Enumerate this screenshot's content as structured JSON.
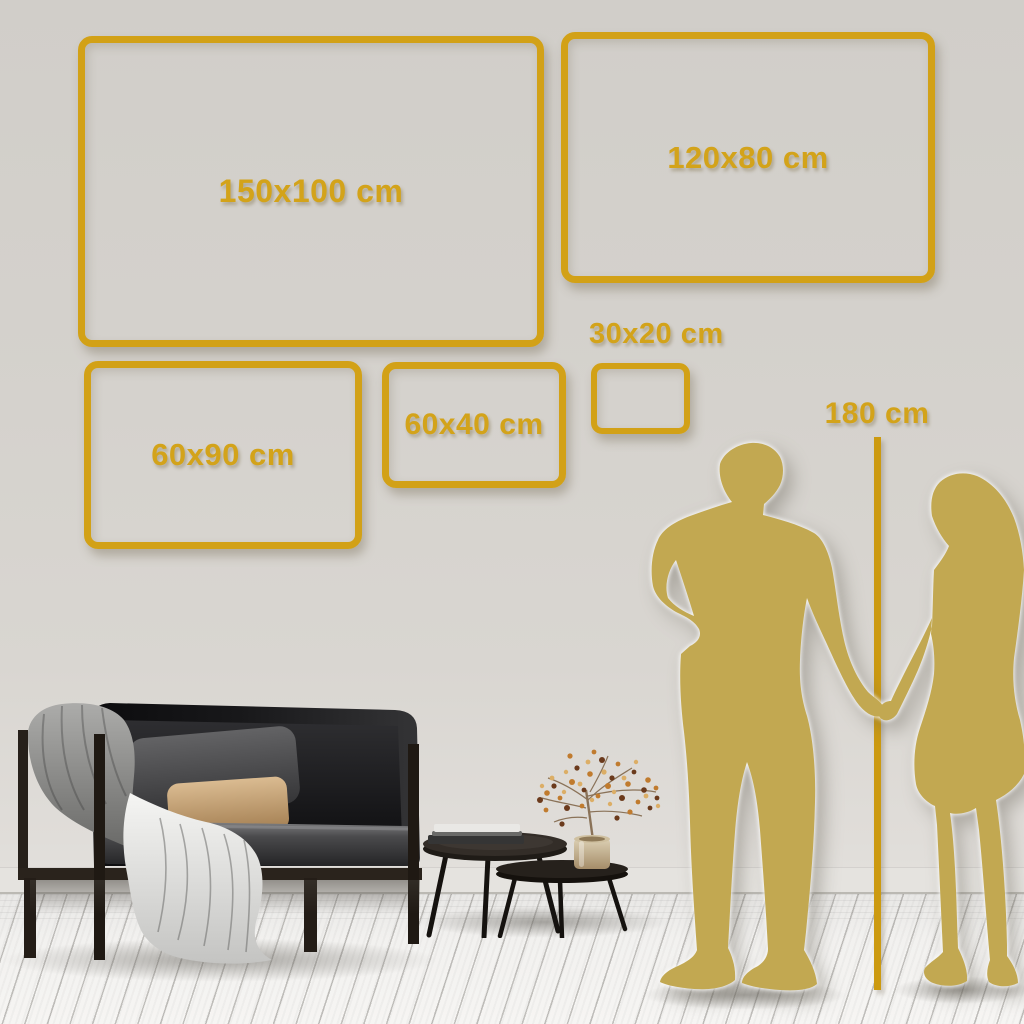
{
  "colors": {
    "accent_gold": "#d2a117",
    "label_gold": "#d3a31a",
    "silhouette_gold": "#c2a851",
    "wall": "#d5d2cd",
    "floor": "#f2f1ef"
  },
  "size_guides": [
    {
      "id": "150x100",
      "label": "150x100 cm",
      "width_cm": 150,
      "height_cm": 100
    },
    {
      "id": "120x80",
      "label": "120x80 cm",
      "width_cm": 120,
      "height_cm": 80
    },
    {
      "id": "60x90",
      "label": "60x90 cm",
      "width_cm": 60,
      "height_cm": 90
    },
    {
      "id": "60x40",
      "label": "60x40 cm",
      "width_cm": 60,
      "height_cm": 40
    },
    {
      "id": "30x20",
      "label": "30x20 cm",
      "width_cm": 30,
      "height_cm": 20
    }
  ],
  "height_reference": {
    "label": "180 cm",
    "height_cm": 180
  }
}
